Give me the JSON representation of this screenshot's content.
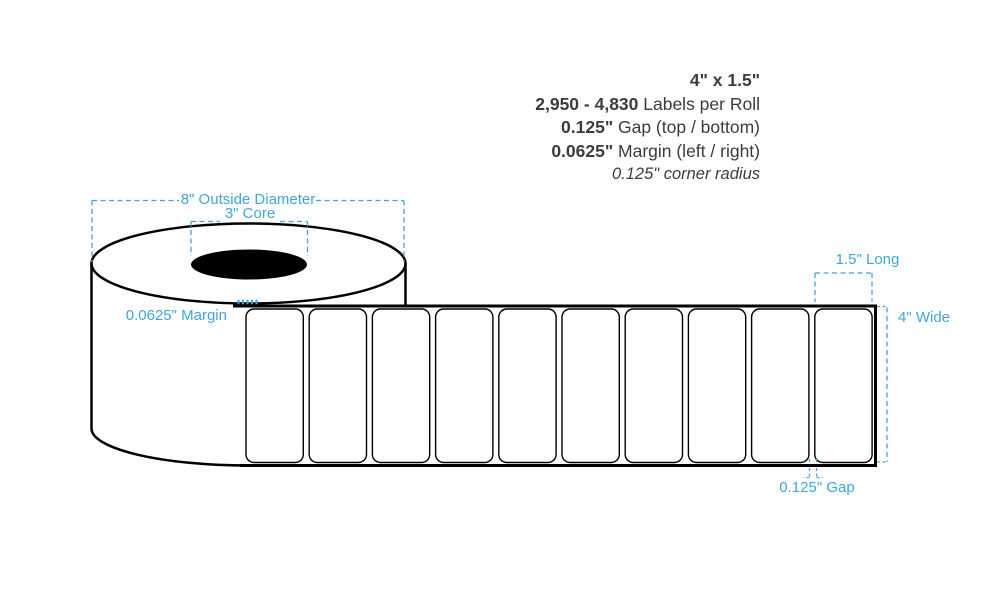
{
  "specs": {
    "size": "4\" x 1.5\"",
    "labels_per_roll_value": "2,950 - 4,830",
    "labels_per_roll_suffix": " Labels per Roll",
    "gap_value": "0.125\"",
    "gap_suffix": " Gap (top / bottom)",
    "margin_value": "0.0625\"",
    "margin_suffix": " Margin (left / right)",
    "corner_radius": "0.125\" corner radius"
  },
  "annotations": {
    "outside_diameter": "8\" Outside Diameter",
    "core": "3\" Core",
    "margin": "0.0625\" Margin",
    "label_length": "1.5\" Long",
    "roll_width": "4\" Wide",
    "label_gap": "0.125\" Gap"
  },
  "diagram": {
    "label_count": 10,
    "annotation_color": "#3FA5DC",
    "outline_color": "#000000",
    "text_color": "#3C3C3C"
  }
}
